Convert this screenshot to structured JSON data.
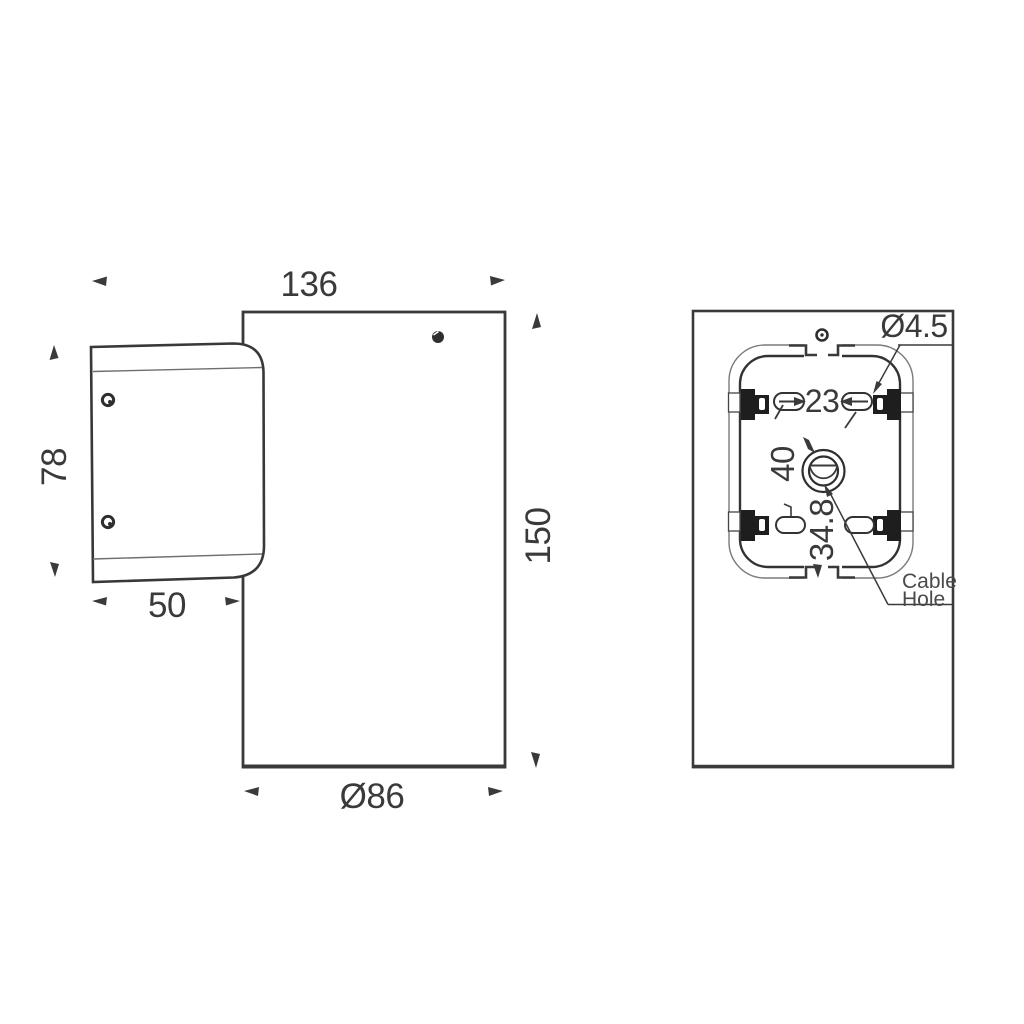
{
  "drawing": {
    "background": "#ffffff",
    "line_color": "#3a3a3a",
    "views": {
      "side_view": {
        "dimensions": {
          "overall_depth": "136",
          "bracket_height": "78",
          "bracket_depth": "50",
          "body_height": "150",
          "body_diameter": "Ø86"
        }
      },
      "back_view": {
        "dimensions": {
          "mounting_hole_diameter": "Ø4.5",
          "slot_center_distance": "23",
          "cable_hole_vertical_offset": "40",
          "cable_hole_horizontal_offset": "34.8"
        },
        "labels": {
          "cable_hole_line1": "Cable",
          "cable_hole_line2": "Hole"
        }
      }
    }
  }
}
